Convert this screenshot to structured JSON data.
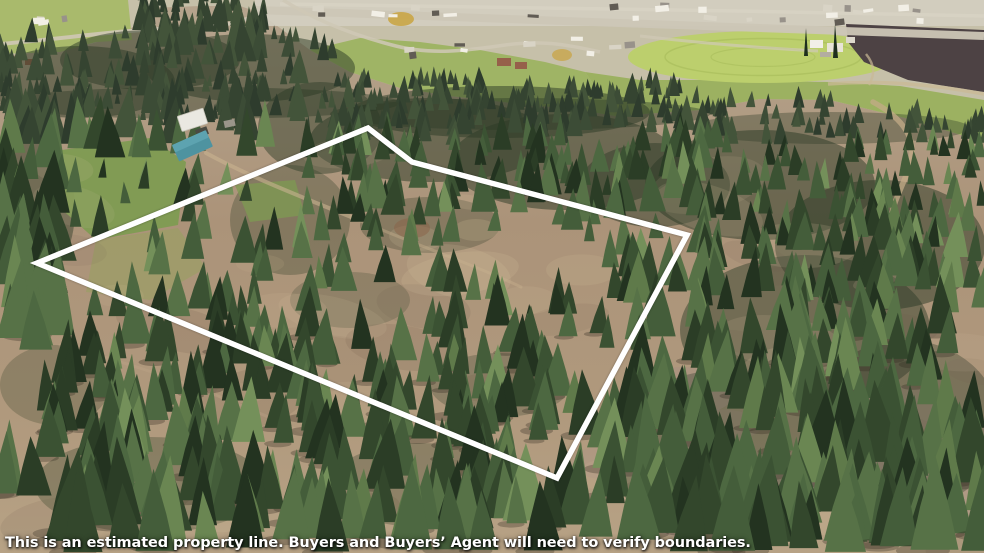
{
  "image": {
    "kind": "aerial-drone-photo",
    "width": 984,
    "height": 553,
    "description": "Oblique aerial photo of a wooded hillside parcel outlined in white, with a small town, highway, irrigated circular field and plowed farmland in the valley beyond"
  },
  "caption": {
    "text": "This is an estimated property line. Buyers and Buyers’ Agent will need to verify boundaries.",
    "color": "#ffffff"
  },
  "property_line": {
    "color": "#ffffff",
    "stroke_width": 5.5,
    "points": "37,263 368,128 412,162 687,235 557,478",
    "vertices": [
      {
        "name": "west-corner",
        "x": 37,
        "y": 263
      },
      {
        "name": "north-peak",
        "x": 368,
        "y": 128
      },
      {
        "name": "north-bend",
        "x": 412,
        "y": 162
      },
      {
        "name": "east-corner",
        "x": 687,
        "y": 235
      },
      {
        "name": "south-corner",
        "x": 557,
        "y": 478
      }
    ]
  },
  "scene": {
    "landmarks": [
      "pine-forest-hillside",
      "estimated-property-boundary",
      "small-town-with-highway",
      "center-pivot-irrigation-field",
      "dark-plowed-field",
      "farmstead-buildings",
      "house-with-teal-roof",
      "green-lawn-clearing",
      "meadow-with-scattered-pines",
      "dirt-roads-and-trails"
    ],
    "colors": {
      "valley_floor": "#c6c0a9",
      "town_strip": "#d3cec0",
      "field_green_left": "#a9ba6c",
      "field_green_center": "#9fb465",
      "pasture": "#9cb161",
      "irrigation_circle": "#bccf6d",
      "irrigation_rings": "#a9bd5c",
      "plowed_field": "#4d4244",
      "highway": "#ccc6b6",
      "minor_road": "#cfc8b6",
      "dirt_road": "#c3ab87",
      "trail": "#c8b28f",
      "lawn": "#7e9b52",
      "clearing": "#97a060",
      "house_roof_white": "#eae8e1",
      "house_roof_teal": "#4e93a0",
      "house_roof_teal_lit": "#5da3b0",
      "shed_gray": "#9a958a",
      "container_rust": "#96604a",
      "autumn_gold": "#c9a33f",
      "red_dirt": "#8a6248",
      "forest_underlay": "#2b3a25"
    },
    "tree_palette": [
      "#233320",
      "#2b3d26",
      "#33472c",
      "#3b5233",
      "#445d3a",
      "#4d6841",
      "#577247"
    ],
    "far_tree_palette": [
      "#2e3c2d",
      "#354431",
      "#3c4c36",
      "#43543a"
    ],
    "sunlit_tree_palette": [
      "#5f7a4a",
      "#6a8652",
      "#74905a"
    ]
  }
}
